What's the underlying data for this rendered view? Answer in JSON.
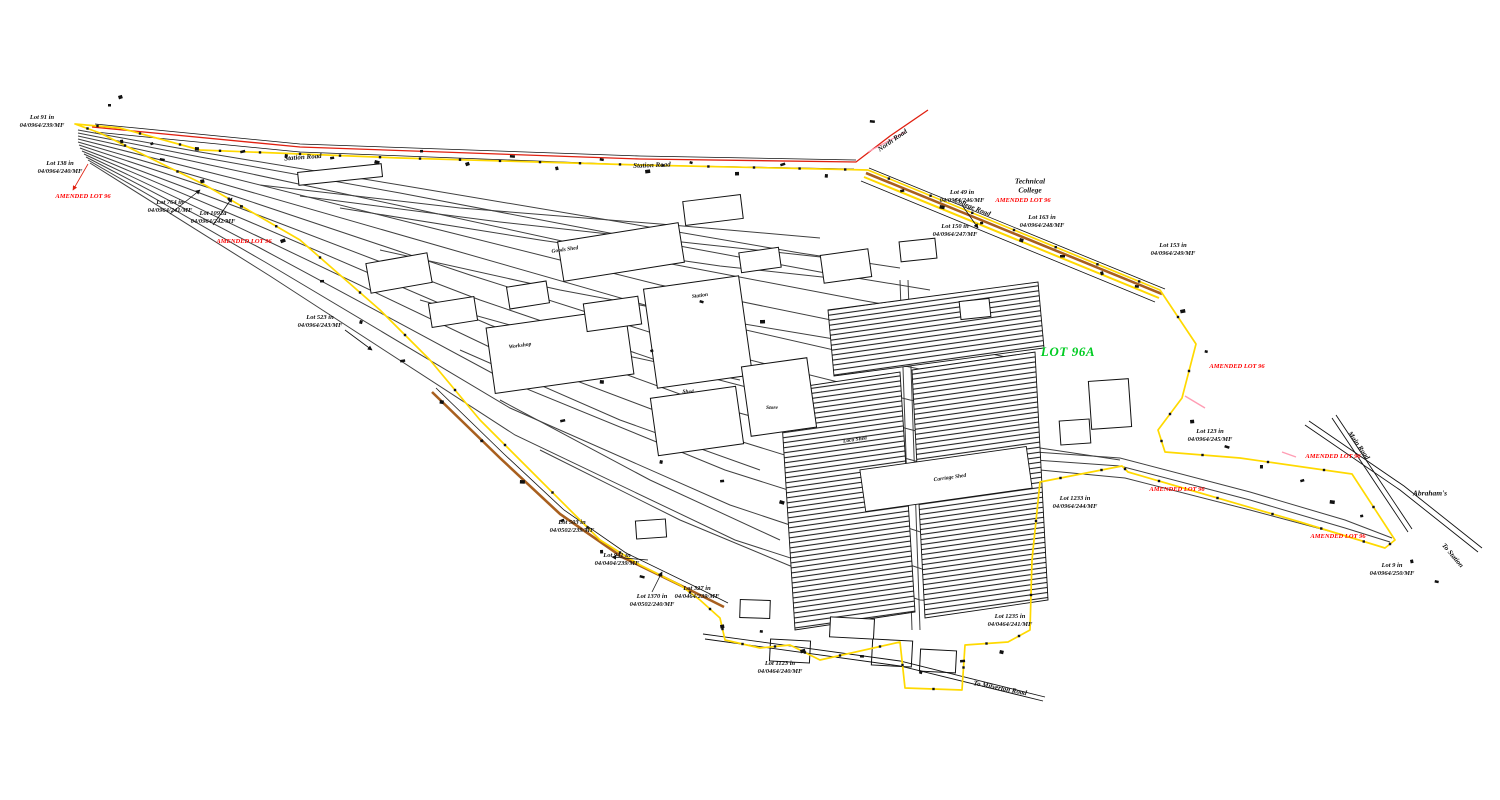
{
  "plan": {
    "primary_lot_label": {
      "text": "LOT 96A",
      "color": "#00cc22"
    }
  },
  "colors": {
    "boundary_yellow": "#FFD900",
    "road_tan": "#A85F1E",
    "road_red": "#E02010",
    "pink": "#FF9DB4",
    "track_gray": "#404040",
    "lot_green": "#00cc22",
    "annotation_red": "#FF0000",
    "ink_black": "#111111"
  },
  "annotations": [
    {
      "id": "lot-91",
      "type": "lot",
      "x": 42,
      "y": 122,
      "lines": [
        "Lot 91 in",
        "04/0964/239/MF"
      ]
    },
    {
      "id": "lot-138",
      "type": "lot",
      "x": 60,
      "y": 168,
      "lines": [
        "Lot 138 in",
        "04/0964/240/MF"
      ]
    },
    {
      "id": "lot-764",
      "type": "lot",
      "x": 170,
      "y": 207,
      "lines": [
        "Lot 764 in",
        "04/0964/241/MF"
      ]
    },
    {
      "id": "lot-1092a",
      "type": "lot",
      "x": 213,
      "y": 218,
      "lines": [
        "Lot 1092a",
        "04/0964/242/MF"
      ]
    },
    {
      "id": "lot-523",
      "type": "lot",
      "x": 320,
      "y": 322,
      "lines": [
        "Lot 523 in",
        "04/0964/243/MF"
      ]
    },
    {
      "id": "lot-503",
      "type": "lot",
      "x": 572,
      "y": 527,
      "lines": [
        "Lot 503 in",
        "04/0502/239/MF"
      ]
    },
    {
      "id": "lot-941",
      "type": "lot",
      "x": 617,
      "y": 560,
      "lines": [
        "Lot 941 in",
        "04/0404/239/MF"
      ]
    },
    {
      "id": "lot-1370",
      "type": "lot",
      "x": 652,
      "y": 601,
      "lines": [
        "Lot 1370 in",
        "04/0502/240/MF"
      ]
    },
    {
      "id": "lot-327",
      "type": "lot",
      "x": 697,
      "y": 593,
      "lines": [
        "Lot 327 in",
        "04/0464/239/MF"
      ]
    },
    {
      "id": "lot-1123",
      "type": "lot",
      "x": 780,
      "y": 668,
      "lines": [
        "Lot 1123 in",
        "04/0464/240/MF"
      ]
    },
    {
      "id": "lot-1235",
      "type": "lot",
      "x": 1010,
      "y": 621,
      "lines": [
        "Lot 1235 in",
        "04/0464/241/MF"
      ]
    },
    {
      "id": "lot-1233",
      "type": "lot",
      "x": 1075,
      "y": 503,
      "lines": [
        "Lot 1233 in",
        "04/0964/244/MF"
      ]
    },
    {
      "id": "lot-123",
      "type": "lot",
      "x": 1210,
      "y": 436,
      "lines": [
        "Lot 123 in",
        "04/0964/245/MF"
      ]
    },
    {
      "id": "lot-49",
      "type": "lot",
      "x": 962,
      "y": 197,
      "lines": [
        "Lot 49 in",
        "04/0964/246/MF"
      ]
    },
    {
      "id": "lot-150",
      "type": "lot",
      "x": 955,
      "y": 231,
      "lines": [
        "Lot 150 in",
        "04/0964/247/MF"
      ]
    },
    {
      "id": "lot-163",
      "type": "lot",
      "x": 1042,
      "y": 222,
      "lines": [
        "Lot 163 in",
        "04/0964/248/MF"
      ]
    },
    {
      "id": "lot-153",
      "type": "lot",
      "x": 1173,
      "y": 250,
      "lines": [
        "Lot 153 in",
        "04/0964/249/MF"
      ]
    },
    {
      "id": "lot-9",
      "type": "lot",
      "x": 1392,
      "y": 570,
      "lines": [
        "Lot 9 in",
        "04/0964/250/MF"
      ]
    },
    {
      "id": "amended-1",
      "type": "red",
      "x": 83,
      "y": 197,
      "lines": [
        "AMENDED LOT 96"
      ]
    },
    {
      "id": "amended-2",
      "type": "red",
      "x": 244,
      "y": 242,
      "lines": [
        "AMENDED LOT 96"
      ]
    },
    {
      "id": "amended-3",
      "type": "red",
      "x": 1023,
      "y": 201,
      "lines": [
        "AMENDED LOT 96"
      ]
    },
    {
      "id": "amended-4",
      "type": "red",
      "x": 1237,
      "y": 367,
      "lines": [
        "AMENDED LOT 96"
      ]
    },
    {
      "id": "amended-5",
      "type": "red",
      "x": 1177,
      "y": 490,
      "lines": [
        "AMENDED LOT 96"
      ]
    },
    {
      "id": "amended-6",
      "type": "red",
      "x": 1333,
      "y": 457,
      "lines": [
        "AMENDED LOT 96"
      ]
    },
    {
      "id": "amended-7",
      "type": "red",
      "x": 1338,
      "y": 537,
      "lines": [
        "AMENDED LOT 96"
      ]
    },
    {
      "id": "road-station-1",
      "type": "road",
      "x": 303,
      "y": 158,
      "rot": -4,
      "lines": [
        "Station Road"
      ]
    },
    {
      "id": "road-station-2",
      "type": "road",
      "x": 652,
      "y": 166,
      "rot": -2,
      "lines": [
        "Station Road"
      ]
    },
    {
      "id": "road-north",
      "type": "road",
      "x": 893,
      "y": 141,
      "rot": -35,
      "lines": [
        "North Road"
      ]
    },
    {
      "id": "road-college",
      "type": "road",
      "x": 972,
      "y": 208,
      "rot": 22,
      "lines": [
        "College Road"
      ]
    },
    {
      "id": "road-main",
      "type": "road",
      "x": 1358,
      "y": 446,
      "rot": 55,
      "lines": [
        "Main Road"
      ]
    },
    {
      "id": "road-to-station",
      "type": "road",
      "x": 1452,
      "y": 556,
      "rot": 50,
      "lines": [
        "To Station"
      ]
    },
    {
      "id": "road-milverton",
      "type": "road",
      "x": 1000,
      "y": 689,
      "rot": 11,
      "lines": [
        "To Milverton Road"
      ]
    },
    {
      "id": "place-technical-college",
      "type": "place",
      "x": 1030,
      "y": 186,
      "lines": [
        "Technical",
        "College"
      ]
    },
    {
      "id": "place-abrahams",
      "type": "place",
      "x": 1430,
      "y": 494,
      "lines": [
        "Abraham's"
      ]
    },
    {
      "id": "bldg-goods-shed",
      "type": "bldg",
      "x": 565,
      "y": 250,
      "rot": -8,
      "lines": [
        "Goods Shed"
      ]
    },
    {
      "id": "bldg-station",
      "type": "bldg",
      "x": 700,
      "y": 296,
      "rot": -8,
      "lines": [
        "Station"
      ]
    },
    {
      "id": "bldg-workshop",
      "type": "bldg",
      "x": 520,
      "y": 346,
      "rot": -8,
      "lines": [
        "Workshop"
      ]
    },
    {
      "id": "bldg-shed",
      "type": "bldg",
      "x": 688,
      "y": 392,
      "rot": 0,
      "lines": [
        "Shed"
      ]
    },
    {
      "id": "bldg-store",
      "type": "bldg",
      "x": 772,
      "y": 408,
      "rot": 0,
      "lines": [
        "Store"
      ]
    },
    {
      "id": "bldg-loco-shed",
      "type": "bldg",
      "x": 855,
      "y": 440,
      "rot": -8,
      "lines": [
        "Loco Shed"
      ]
    },
    {
      "id": "bldg-carriage-shed",
      "type": "bldg",
      "x": 950,
      "y": 478,
      "rot": -8,
      "lines": [
        "Carriage Shed"
      ]
    }
  ]
}
